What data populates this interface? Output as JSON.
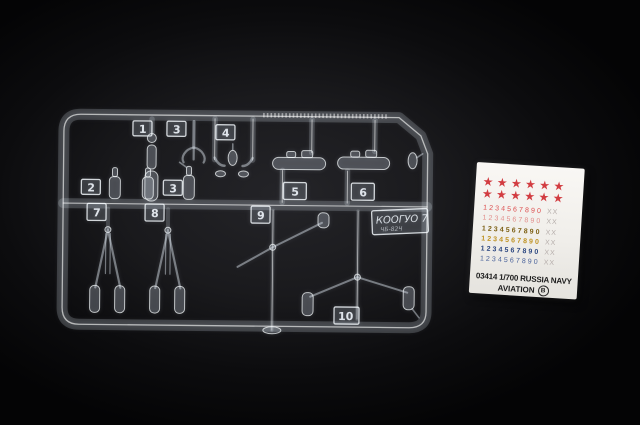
{
  "sprue": {
    "part_tags": [
      {
        "label": "1"
      },
      {
        "label": "3"
      },
      {
        "label": "4"
      },
      {
        "label": "2"
      },
      {
        "label": "3"
      },
      {
        "label": "5"
      },
      {
        "label": "6"
      },
      {
        "label": "7"
      },
      {
        "label": "8"
      },
      {
        "label": "9"
      },
      {
        "label": "10"
      }
    ],
    "mold_tag": {
      "line1": "КООГУО 7",
      "line2": "ЧБ-82Ч"
    }
  },
  "decal_sheet": {
    "stars": {
      "rows": 2,
      "per_row": 6,
      "glyph": "★",
      "color": "#d23c41"
    },
    "number_rows": [
      {
        "digits": "1234567890",
        "suffix": "XX",
        "color": "#dd4d4d",
        "bold": false
      },
      {
        "digits": "1234567890",
        "suffix": "XX",
        "color": "#e2908d",
        "bold": false
      },
      {
        "digits": "1234567890",
        "suffix": "XX",
        "color": "#7d6015",
        "bold": true
      },
      {
        "digits": "1234567890",
        "suffix": "XX",
        "color": "#bf9222",
        "bold": true
      },
      {
        "digits": "1234567890",
        "suffix": "XX",
        "color": "#2c4780",
        "bold": true
      },
      {
        "digits": "1234567890",
        "suffix": "XX",
        "color": "#4b639b",
        "bold": false
      }
    ],
    "suffix_color": "#b5adaa",
    "footer_line1": "03414 1/700 RUSSIA NAVY",
    "footer_line2": "AVIATION",
    "footer_badge": "B"
  }
}
